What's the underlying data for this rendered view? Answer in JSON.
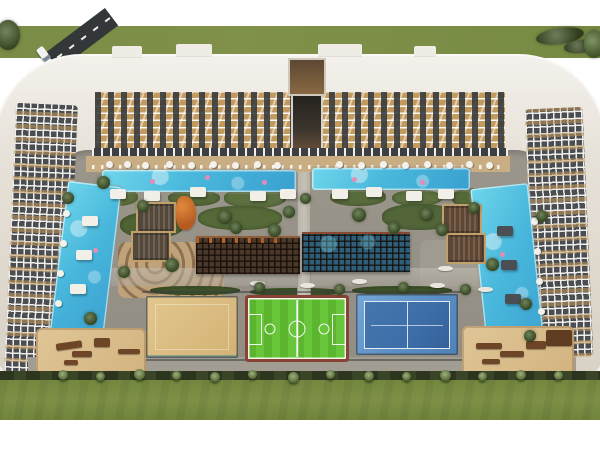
{
  "scene": {
    "description": "Aerial architectural rendering of a U-shaped residential complex with wavy-balcony facades around a landscaped courtyard containing two L-shaped swimming pools, a central dark wooden lattice canopy over an indoor pool, a sand court, a green football pitch, a blue tennis court, sand playground and lounge areas, palm-lined edge, lawn strips and an access road at the top left."
  },
  "palette": {
    "white": "#ffffff",
    "grass": "#7c8e46",
    "road": "#33373a",
    "roof": "#efece6",
    "facade-tan": "#c29a5e",
    "facade-dark": "#4a4e52",
    "deck": "#c9ad83",
    "planting": "#5d6f3d",
    "pool": "#6fd6ec",
    "pool-deep": "#3aa0cf",
    "canopy": "#4a382a",
    "canopy-pool": "#2e5e78",
    "sand": "#d3b274",
    "pitch": "#5cb52f",
    "court-red": "#8a4136",
    "tennis-outer": "#5b8ec4",
    "tennis-inner": "#3d6ea8",
    "hedge": "#2d351f",
    "wood": "#6e4526",
    "slide-orange": "#e08a3c",
    "float-pink": "#e88ab8"
  },
  "objects": {
    "roof_notches": [
      {
        "l": 112,
        "t": 46,
        "w": 30,
        "h": 11
      },
      {
        "l": 176,
        "t": 44,
        "w": 36,
        "h": 12
      },
      {
        "l": 318,
        "t": 44,
        "w": 44,
        "h": 12
      },
      {
        "l": 414,
        "t": 46,
        "w": 22,
        "h": 10
      }
    ],
    "top_trees": [
      {
        "l": -4,
        "t": 20,
        "w": 24,
        "h": 30,
        "bgc": "#4c6330"
      },
      {
        "l": 536,
        "t": 28,
        "w": 48,
        "h": 16,
        "bgc": "#46582c",
        "tr": "rotate(-8deg)"
      },
      {
        "l": 564,
        "t": 40,
        "w": 32,
        "h": 13,
        "bgc": "#3f5128",
        "tr": "rotate(-6deg)"
      },
      {
        "l": 584,
        "t": 30,
        "w": 20,
        "h": 28,
        "bgc": "#5c763a"
      }
    ],
    "planting": [
      {
        "l": 92,
        "t": 188,
        "w": 46,
        "h": 18
      },
      {
        "l": 168,
        "t": 190,
        "w": 52,
        "h": 16,
        "bgc": "#57693a"
      },
      {
        "l": 224,
        "t": 188,
        "w": 62,
        "h": 20,
        "bgc": "#5d7040"
      },
      {
        "l": 330,
        "t": 188,
        "w": 56,
        "h": 18,
        "bgc": "#586b3b"
      },
      {
        "l": 392,
        "t": 190,
        "w": 50,
        "h": 16,
        "bgc": "#5e7140"
      },
      {
        "l": 452,
        "t": 188,
        "w": 44,
        "h": 20,
        "bgc": "#556838"
      },
      {
        "l": 120,
        "t": 212,
        "w": 64,
        "h": 26,
        "bgc": "#4e6233"
      },
      {
        "l": 198,
        "t": 206,
        "w": 84,
        "h": 24,
        "bgc": "#566a39"
      },
      {
        "l": 382,
        "t": 204,
        "w": 74,
        "h": 26,
        "bgc": "#52663a"
      },
      {
        "l": 452,
        "t": 208,
        "w": 56,
        "h": 28,
        "bgc": "#4e6233"
      },
      {
        "l": 150,
        "t": 286,
        "w": 90,
        "h": 9,
        "bgc": "#3f5229"
      },
      {
        "l": 250,
        "t": 288,
        "w": 92,
        "h": 8,
        "bgc": "#3f5229"
      },
      {
        "l": 352,
        "t": 286,
        "w": 100,
        "h": 9,
        "bgc": "#3f5229"
      },
      {
        "l": 62,
        "t": 200,
        "w": 14,
        "h": 126,
        "bgc": "#4a5e30",
        "tr": "rotate(6deg)"
      },
      {
        "l": 516,
        "t": 210,
        "w": 14,
        "h": 110,
        "bgc": "#4a5e30",
        "tr": "rotate(-5deg)"
      },
      {
        "l": 58,
        "t": 190,
        "w": 10,
        "h": 146,
        "bgc": "#c3ab84",
        "tr": "rotate(7deg)",
        "br": "2px"
      },
      {
        "l": 534,
        "t": 196,
        "w": 12,
        "h": 156,
        "bgc": "#c3ab84",
        "tr": "rotate(-5deg)",
        "br": "2px"
      }
    ],
    "floats": [
      {
        "l": 150,
        "t": 179
      },
      {
        "l": 205,
        "t": 175
      },
      {
        "l": 262,
        "t": 180
      },
      {
        "l": 352,
        "t": 177
      },
      {
        "l": 420,
        "t": 180
      },
      {
        "l": 93,
        "t": 248
      },
      {
        "l": 500,
        "t": 252
      }
    ],
    "umbrellas": [
      {
        "l": 106,
        "t": 161
      },
      {
        "l": 124,
        "t": 161
      },
      {
        "l": 142,
        "t": 162
      },
      {
        "l": 166,
        "t": 161
      },
      {
        "l": 188,
        "t": 162
      },
      {
        "l": 210,
        "t": 161
      },
      {
        "l": 232,
        "t": 162
      },
      {
        "l": 254,
        "t": 161
      },
      {
        "l": 274,
        "t": 162
      },
      {
        "l": 336,
        "t": 161
      },
      {
        "l": 358,
        "t": 162
      },
      {
        "l": 380,
        "t": 161
      },
      {
        "l": 402,
        "t": 162
      },
      {
        "l": 424,
        "t": 161
      },
      {
        "l": 446,
        "t": 162
      },
      {
        "l": 466,
        "t": 161
      },
      {
        "l": 486,
        "t": 162
      },
      {
        "l": 63,
        "t": 210
      },
      {
        "l": 60,
        "t": 240
      },
      {
        "l": 57,
        "t": 270
      },
      {
        "l": 55,
        "t": 300
      },
      {
        "l": 531,
        "t": 218
      },
      {
        "l": 534,
        "t": 248
      },
      {
        "l": 536,
        "t": 278
      },
      {
        "l": 538,
        "t": 308
      },
      {
        "l": 540,
        "t": 332
      }
    ],
    "cabanas": [
      {
        "l": 110,
        "t": 189
      },
      {
        "l": 144,
        "t": 191
      },
      {
        "l": 190,
        "t": 187
      },
      {
        "l": 250,
        "t": 191
      },
      {
        "l": 280,
        "t": 189
      },
      {
        "l": 332,
        "t": 189
      },
      {
        "l": 366,
        "t": 187
      },
      {
        "l": 406,
        "t": 191
      },
      {
        "l": 438,
        "t": 189
      },
      {
        "l": 82,
        "t": 216
      },
      {
        "l": 76,
        "t": 250
      },
      {
        "l": 70,
        "t": 284
      },
      {
        "l": 497,
        "t": 226,
        "bgc": "#4b4f54"
      },
      {
        "l": 501,
        "t": 260,
        "bgc": "#4b4f54"
      },
      {
        "l": 505,
        "t": 294,
        "bgc": "#4b4f54"
      }
    ],
    "plazas": [
      {
        "l": 136,
        "t": 202
      },
      {
        "l": 131,
        "t": 231
      },
      {
        "l": 442,
        "t": 204,
        "bgc": "#5e4632"
      },
      {
        "l": 446,
        "t": 233,
        "bgc": "#5e4632"
      }
    ],
    "benches": [
      {
        "l": 250,
        "t": 281
      },
      {
        "l": 300,
        "t": 283
      },
      {
        "l": 352,
        "t": 279
      },
      {
        "l": 430,
        "t": 283
      },
      {
        "l": 478,
        "t": 287
      },
      {
        "l": 438,
        "t": 266
      }
    ],
    "wood_features": [
      {
        "l": 56,
        "t": 342,
        "w": 26,
        "h": 7,
        "tr": "rotate(-8deg)"
      },
      {
        "l": 72,
        "t": 351,
        "w": 20,
        "h": 6
      },
      {
        "l": 94,
        "t": 338,
        "w": 16,
        "h": 9
      },
      {
        "l": 118,
        "t": 349,
        "w": 22,
        "h": 5
      },
      {
        "l": 64,
        "t": 360,
        "w": 14,
        "h": 5
      },
      {
        "l": 476,
        "t": 343,
        "w": 26,
        "h": 6
      },
      {
        "l": 500,
        "t": 351,
        "w": 24,
        "h": 6
      },
      {
        "l": 526,
        "t": 341,
        "w": 20,
        "h": 8
      },
      {
        "l": 546,
        "t": 330,
        "w": 26,
        "h": 16,
        "bgc": "#5f3d22"
      },
      {
        "l": 482,
        "t": 359,
        "w": 18,
        "h": 5
      }
    ],
    "trees": [
      {
        "l": 97,
        "t": 176,
        "w": 13,
        "h": 13
      },
      {
        "l": 137,
        "t": 200,
        "w": 12,
        "h": 12
      },
      {
        "l": 218,
        "t": 210,
        "w": 14,
        "h": 14
      },
      {
        "l": 283,
        "t": 206,
        "w": 12,
        "h": 12
      },
      {
        "l": 300,
        "t": 193,
        "w": 11,
        "h": 11
      },
      {
        "l": 352,
        "t": 208,
        "w": 14,
        "h": 14
      },
      {
        "l": 420,
        "t": 208,
        "w": 13,
        "h": 13
      },
      {
        "l": 468,
        "t": 202,
        "w": 12,
        "h": 12
      },
      {
        "l": 62,
        "t": 192,
        "w": 12,
        "h": 12
      },
      {
        "l": 536,
        "t": 210,
        "w": 12,
        "h": 12
      },
      {
        "l": 230,
        "t": 222,
        "w": 12,
        "h": 12
      },
      {
        "l": 268,
        "t": 224,
        "w": 13,
        "h": 13
      },
      {
        "l": 388,
        "t": 222,
        "w": 12,
        "h": 12
      },
      {
        "l": 436,
        "t": 224,
        "w": 12,
        "h": 12
      },
      {
        "l": 165,
        "t": 258,
        "w": 14,
        "h": 14
      },
      {
        "l": 118,
        "t": 266,
        "w": 12,
        "h": 12
      },
      {
        "l": 486,
        "t": 258,
        "w": 13,
        "h": 13
      },
      {
        "l": 520,
        "t": 298,
        "w": 12,
        "h": 12
      },
      {
        "l": 84,
        "t": 312,
        "w": 13,
        "h": 13
      },
      {
        "l": 524,
        "t": 330,
        "w": 12,
        "h": 12
      },
      {
        "l": 254,
        "t": 282,
        "w": 11,
        "h": 11
      },
      {
        "l": 334,
        "t": 284,
        "w": 11,
        "h": 11
      },
      {
        "l": 398,
        "t": 282,
        "w": 11,
        "h": 11
      },
      {
        "l": 460,
        "t": 284,
        "w": 11,
        "h": 11
      }
    ],
    "palms": [
      {
        "l": 58,
        "t": 370,
        "w": 10,
        "h": 10
      },
      {
        "l": 96,
        "t": 372,
        "w": 9,
        "h": 9
      },
      {
        "l": 134,
        "t": 369,
        "w": 11,
        "h": 11
      },
      {
        "l": 172,
        "t": 371,
        "w": 9,
        "h": 9
      },
      {
        "l": 210,
        "t": 372,
        "w": 10,
        "h": 10
      },
      {
        "l": 248,
        "t": 370,
        "w": 9,
        "h": 9
      },
      {
        "l": 288,
        "t": 372,
        "w": 11,
        "h": 11
      },
      {
        "l": 326,
        "t": 370,
        "w": 9,
        "h": 9
      },
      {
        "l": 364,
        "t": 371,
        "w": 10,
        "h": 10
      },
      {
        "l": 402,
        "t": 372,
        "w": 9,
        "h": 9
      },
      {
        "l": 440,
        "t": 370,
        "w": 11,
        "h": 11
      },
      {
        "l": 478,
        "t": 372,
        "w": 9,
        "h": 9
      },
      {
        "l": 516,
        "t": 370,
        "w": 10,
        "h": 10
      },
      {
        "l": 554,
        "t": 371,
        "w": 9,
        "h": 9
      }
    ]
  }
}
